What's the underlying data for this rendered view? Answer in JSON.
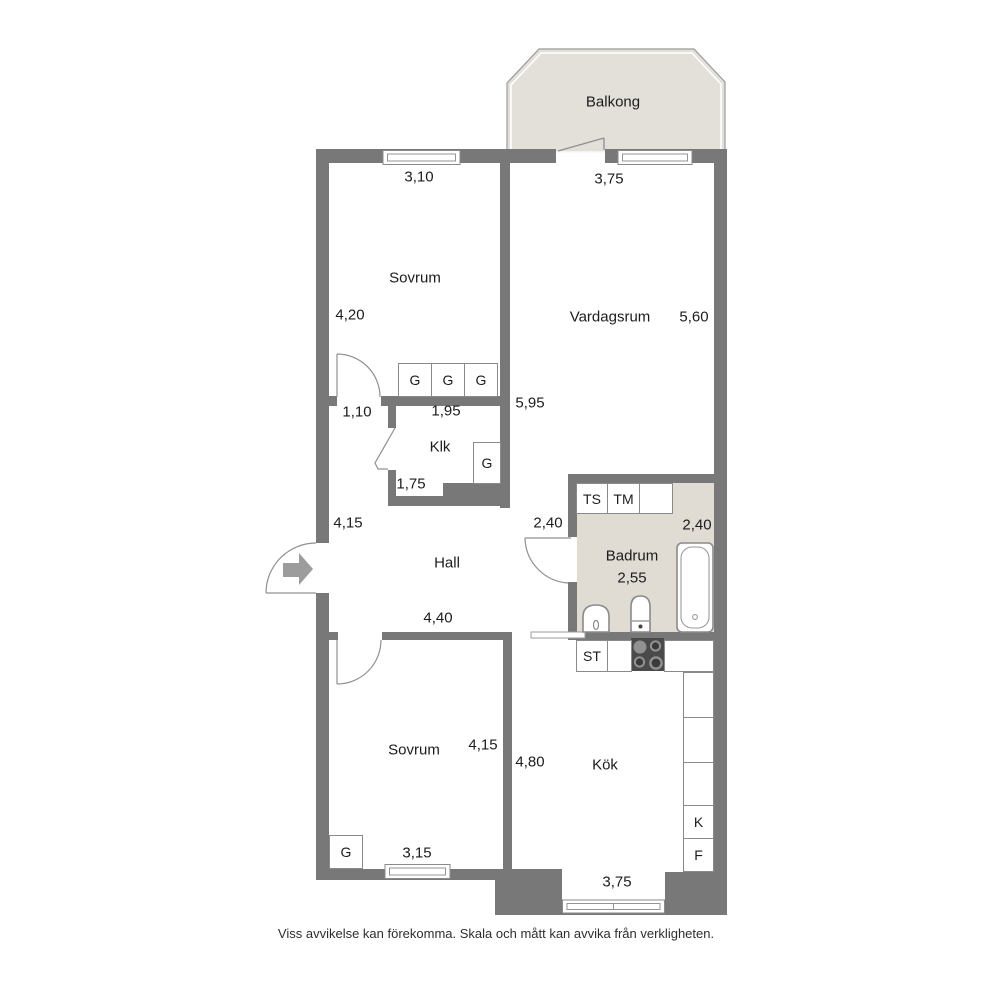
{
  "colors": {
    "wall": "#787878",
    "balcony_floor": "#e3e0da",
    "bathroom_floor": "#e0dbd3",
    "line": "#8a8a8a",
    "text": "#1c1c1c"
  },
  "balcony": {
    "label": "Balkong"
  },
  "rooms": {
    "sovrum_top": {
      "name": "Sovrum",
      "window_width": "3,10",
      "depth": "4,20",
      "door_width": "1,10"
    },
    "vardagsrum": {
      "name": "Vardagsrum",
      "window_width": "3,75",
      "depth": "5,60",
      "wall_length": "5,95"
    },
    "klk": {
      "name": "Klk",
      "width": "1,95",
      "depth": "1,75"
    },
    "hall": {
      "name": "Hall",
      "length": "4,15",
      "width": "4,40",
      "opening": "2,40"
    },
    "badrum": {
      "name": "Badrum",
      "width": "2,55",
      "depth": "2,40"
    },
    "sovrum_bottom": {
      "name": "Sovrum",
      "depth": "4,15",
      "window_width": "3,15"
    },
    "kok": {
      "name": "Kök",
      "depth": "4,80",
      "window_width": "3,75"
    }
  },
  "labels": {
    "wardrobe": "G",
    "drying_cabinet": "TS",
    "washing_machine": "TM",
    "cleaning_cabinet": "ST",
    "fridge": "K",
    "freezer": "F"
  },
  "footer": "Viss avvikelse kan förekomma. Skala och mått kan avvika från verkligheten."
}
